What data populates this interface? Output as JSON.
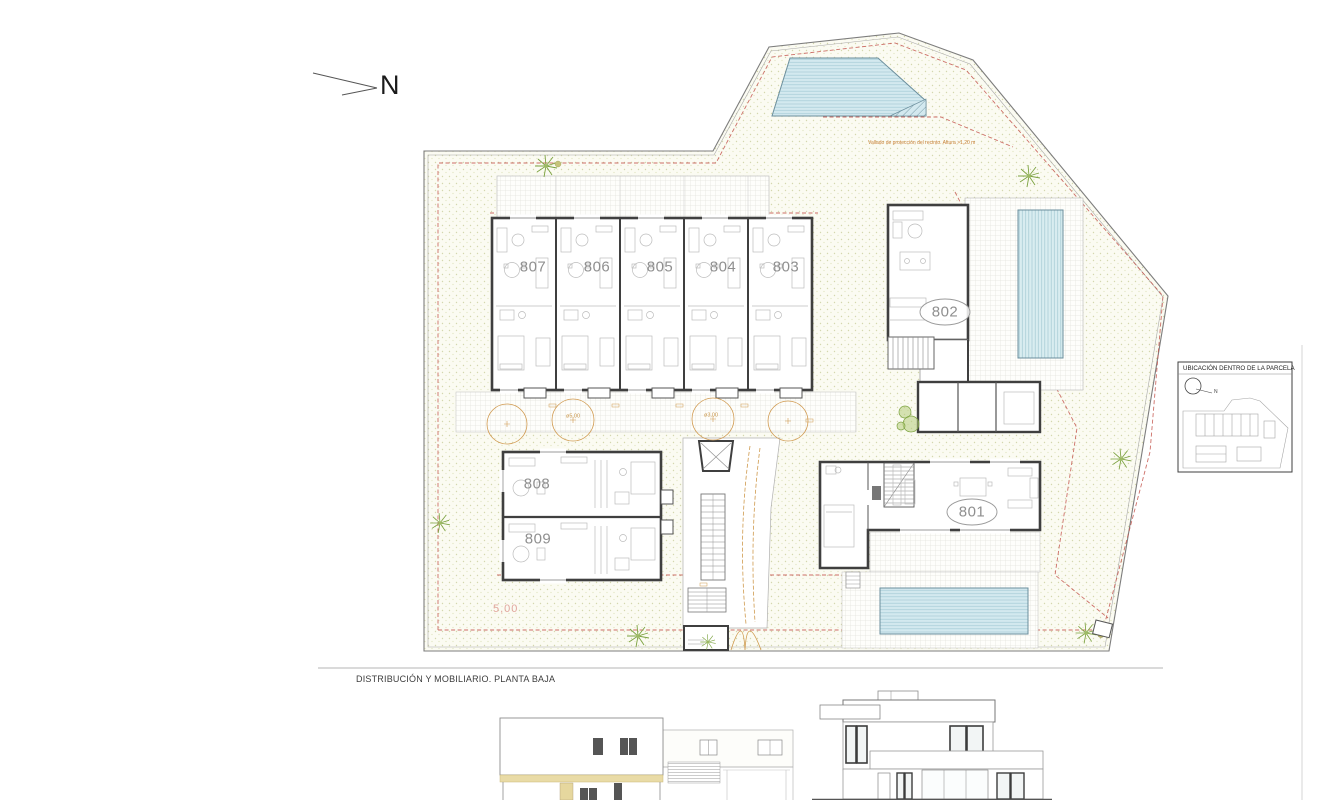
{
  "sheet": {
    "section_title": "DISTRIBUCIÓN Y MOBILIARIO. PLANTA BAJA"
  },
  "north_arrow": {
    "label": "N"
  },
  "plan": {
    "fence_note": "Vallado de protección del recinto. Altura >1,20 m",
    "units": {
      "u801": "801",
      "u802": "802",
      "u803": "803",
      "u804": "804",
      "u805": "805",
      "u806": "806",
      "u807": "807",
      "u808": "808",
      "u809": "809"
    },
    "annotations": {
      "setback_dim": "5,00",
      "tree_dia_large": "ø5,00",
      "tree_dia_small": "ø3,00"
    }
  },
  "inset": {
    "title": "UBICACIÓN DENTRO DE LA PARCELA",
    "north_label": "N"
  },
  "colors": {
    "wall": "#3f3f3f",
    "pool_water": "#d3e9ef",
    "garden_dot": "#d4d7ae",
    "fence_line": "#c4564e",
    "annotation_orange": "#cf9a4e",
    "band_tan": "#e9dba6"
  }
}
